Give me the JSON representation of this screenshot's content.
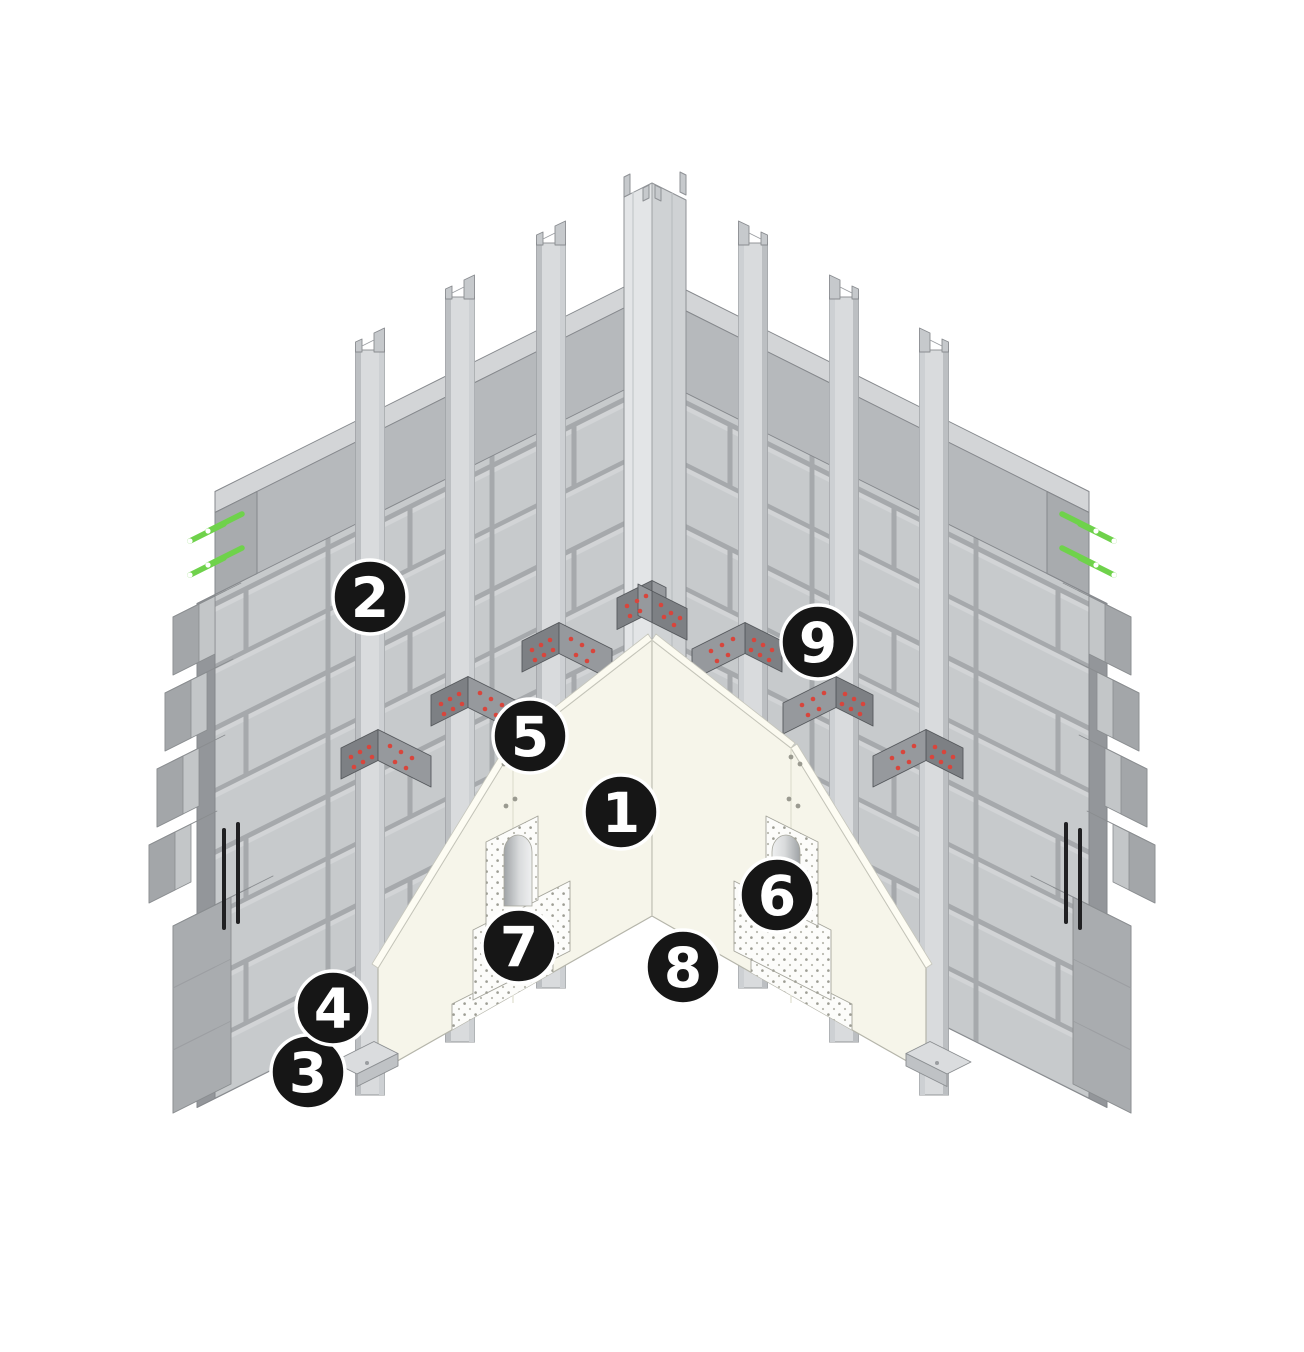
{
  "callouts": {
    "n1": {
      "label": "1",
      "transform": "translate(621,812)"
    },
    "n2": {
      "label": "2",
      "transform": "translate(370,597)"
    },
    "n3": {
      "label": "3",
      "transform": "translate(308,1072)"
    },
    "n4": {
      "label": "4",
      "transform": "translate(333,1008)"
    },
    "n5": {
      "label": "5",
      "transform": "translate(530,736)"
    },
    "n6": {
      "label": "6",
      "transform": "translate(777,895)"
    },
    "n7": {
      "label": "7",
      "transform": "translate(519,946)"
    },
    "n8": {
      "label": "8",
      "transform": "translate(683,967)"
    },
    "n9": {
      "label": "9",
      "transform": "translate(818,642)"
    }
  },
  "colors": {
    "background": "#ffffff",
    "block_face": "#c7cacc",
    "mortar_joint": "#a6a9ac",
    "bond_beam_face": "#b6b9bc",
    "bond_beam_top": "#d3d5d7",
    "stud_face": "#d9dbdd",
    "bracket_plate": "#7d8084",
    "bracket_wing": "#96999d",
    "screw_red": "#d8453c",
    "dowel_green": "#6fd24b",
    "sheathing_cream": "#f6f5ea",
    "insulation_dotted": "#fcfcfa",
    "rebar_black": "#202022",
    "badge_background": "#161616",
    "badge_number": "#ffffff"
  }
}
